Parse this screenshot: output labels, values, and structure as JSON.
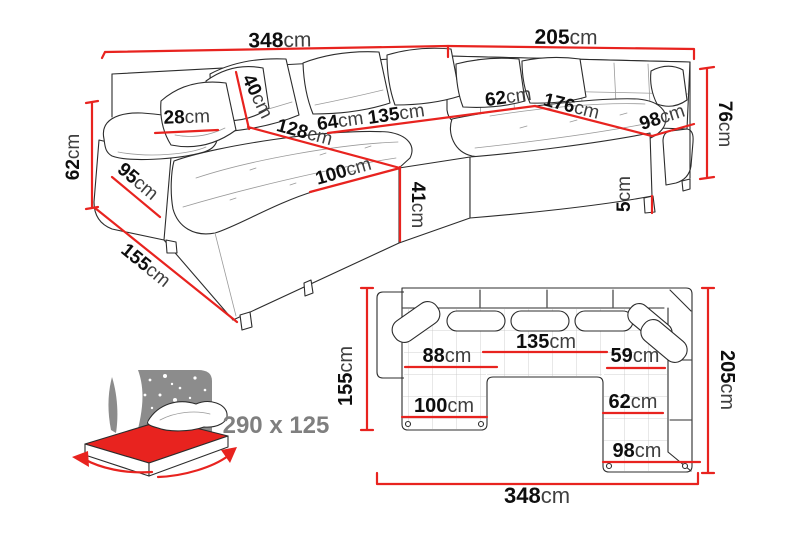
{
  "colors": {
    "dimension_line": "#e8231f",
    "line_art": "#2c2c2c",
    "size_text": "#7f7f7f"
  },
  "perspective_view": {
    "dims": {
      "total_width": {
        "value": "348",
        "unit": "cm"
      },
      "right_side_width": {
        "value": "205",
        "unit": "cm"
      },
      "back_height": {
        "value": "62",
        "unit": "cm"
      },
      "side_depth": {
        "value": "155",
        "unit": "cm"
      },
      "armrest_depth": {
        "value": "95",
        "unit": "cm"
      },
      "armrest_width": {
        "value": "28",
        "unit": "cm"
      },
      "back_cushion_height": {
        "value": "40",
        "unit": "cm"
      },
      "seat_64": {
        "value": "64",
        "unit": "cm"
      },
      "seat_135": {
        "value": "135",
        "unit": "cm"
      },
      "chaise_length": {
        "value": "128",
        "unit": "cm"
      },
      "seat_62": {
        "value": "62",
        "unit": "cm"
      },
      "right_seat_length": {
        "value": "176",
        "unit": "cm"
      },
      "right_seat_depth": {
        "value": "98",
        "unit": "cm"
      },
      "chaise_width": {
        "value": "100",
        "unit": "cm"
      },
      "seat_height": {
        "value": "41",
        "unit": "cm"
      },
      "leg_height": {
        "value": "5",
        "unit": "cm"
      },
      "right_back_height": {
        "value": "76",
        "unit": "cm"
      }
    }
  },
  "sleeping_area": {
    "size_label": "290 x 125"
  },
  "top_view": {
    "dims": {
      "left_depth": {
        "value": "155",
        "unit": "cm"
      },
      "right_depth": {
        "value": "205",
        "unit": "cm"
      },
      "total_width": {
        "value": "348",
        "unit": "cm"
      },
      "middle_seat_width": {
        "value": "135",
        "unit": "cm"
      },
      "left_seat_width": {
        "value": "88",
        "unit": "cm"
      },
      "right_seat_width": {
        "value": "59",
        "unit": "cm"
      },
      "right_seat_depth1": {
        "value": "62",
        "unit": "cm"
      },
      "chaise_width": {
        "value": "100",
        "unit": "cm"
      },
      "right_seat_depth2": {
        "value": "98",
        "unit": "cm"
      }
    }
  }
}
